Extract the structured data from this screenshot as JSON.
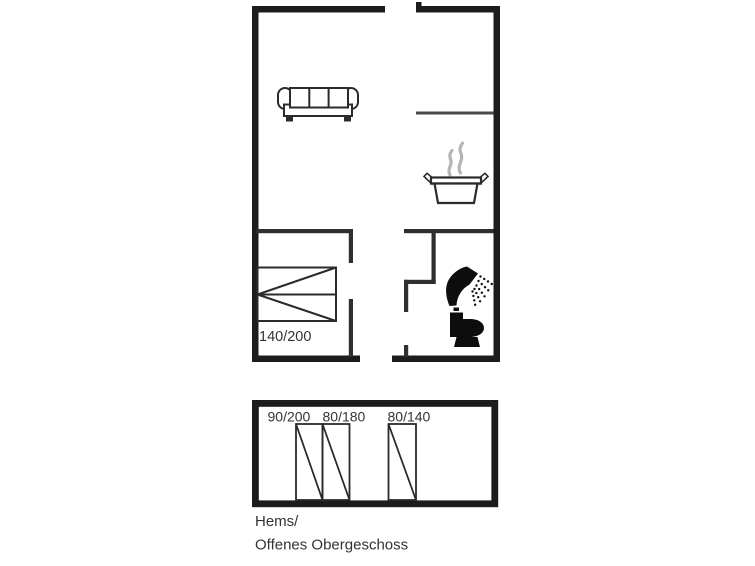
{
  "colors": {
    "background": "#ffffff",
    "exterior_wall": "#1c1c1c",
    "interior_wall": "#2f2f2f",
    "partition_wall": "#4a4a4a",
    "furniture_line": "#2b2b2b",
    "fixture_black": "#0d0d0d",
    "steam_gray": "#b5b5b5",
    "label_text": "#333333",
    "room_fill": "#ffffff"
  },
  "main_floor": {
    "icons": [
      "sofa-icon",
      "steam-icon",
      "cooking-pot-icon",
      "shower-icon",
      "toilet-icon",
      "double-bed-icon"
    ],
    "double_bed": {
      "size_label": "140/200"
    }
  },
  "hems_floor": {
    "beds": [
      {
        "size_label": "90/200"
      },
      {
        "size_label": "80/180"
      },
      {
        "size_label": "80/140"
      }
    ],
    "caption_line1": "Hems/",
    "caption_line2": "Offenes Obergeschoss"
  }
}
